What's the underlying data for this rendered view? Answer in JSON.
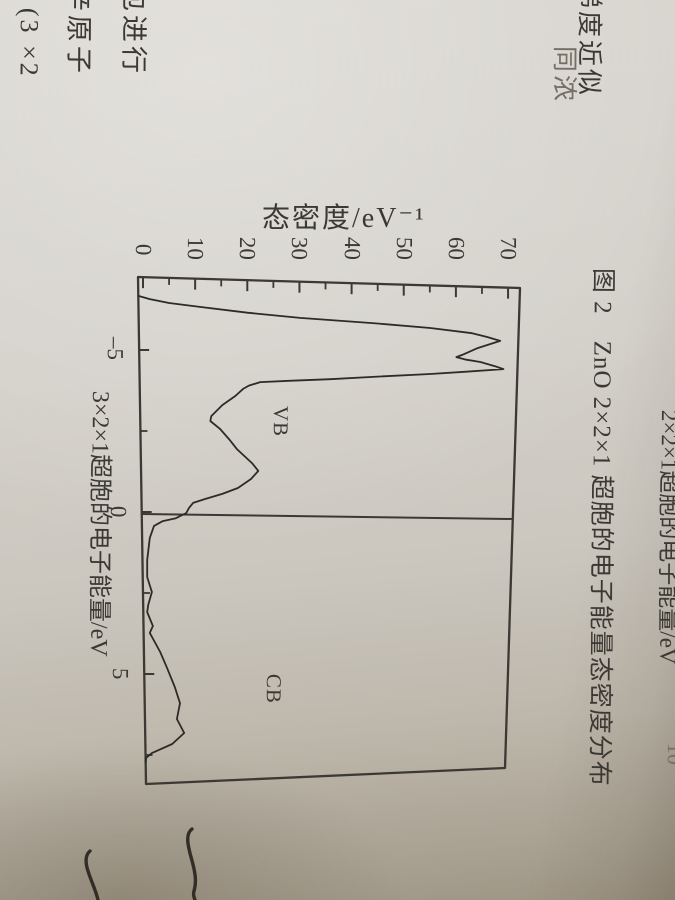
{
  "page": {
    "ylabel": "态密度/eV⁻¹",
    "vb_label": "VB",
    "cb_label": "CB",
    "fig3_xaxis_label": "3×2×1超胞的电子能量/eV",
    "fig2_xaxis_label": "2×2×1超胞的电子能量/eV",
    "fig2_caption": "图 2　ZnO 2×2×1 超胞的电子能量态密度分布",
    "page_number_fragment": "10",
    "body_text_fragments": {
      "line_end_1": "包进行",
      "line_end_2": "辛原子",
      "line_end_3": "(3 ×2",
      "line_end_4": "梯度近似",
      "line_end_5": "同浓"
    }
  },
  "chart_data": {
    "type": "line",
    "title": "ZnO supercell electronic density of states (figure printed sideways on page)",
    "xlabel": "3×2×1超胞的电子能量/eV",
    "ylabel": "态密度/eV⁻¹",
    "xlim": [
      -7.3,
      8.4
    ],
    "ylim": [
      0,
      70
    ],
    "x_ticks": [
      -5,
      0,
      5
    ],
    "x_ticks_minor": [
      -2.5,
      2.5,
      7.5
    ],
    "y_ticks": [
      0,
      10,
      20,
      30,
      40,
      50,
      60,
      70
    ],
    "y_ticks_minor": [
      5,
      15,
      25,
      35,
      45,
      55,
      65
    ],
    "fermi_line_x": 0,
    "annotations": [
      "VB",
      "CB"
    ],
    "legend": [],
    "grid": false,
    "series": [
      {
        "name": "total DOS",
        "energy": [
          -6.67,
          -6.57,
          -6.45,
          -6.33,
          -6.15,
          -5.99,
          -5.83,
          -5.68,
          -5.52,
          -5.4,
          -5.28,
          -5.05,
          -4.85,
          -4.78,
          -4.7,
          -4.63,
          -4.5,
          -4.41,
          -4.33,
          -4.26,
          -4.18,
          -4.1,
          -4.05,
          -4.01,
          -3.9,
          -3.8,
          -3.58,
          -3.3,
          -2.96,
          -2.81,
          -2.56,
          -2.25,
          -1.94,
          -1.51,
          -1.27,
          -1.02,
          -0.74,
          -0.56,
          -0.4,
          -0.28,
          -0.12,
          0.03,
          0.19,
          0.28,
          0.43,
          0.8,
          1.48,
          2.01,
          2.47,
          2.87,
          3.09,
          3.52,
          3.73,
          4.32,
          4.81,
          5.4,
          5.9,
          6.39,
          6.82,
          7.16,
          7.44,
          7.59,
          7.72
        ],
        "dos": [
          -0.9,
          1.3,
          5.0,
          10.9,
          20.0,
          30.1,
          44.0,
          55.1,
          63.1,
          66.0,
          68.5,
          64.0,
          61.2,
          60.1,
          62.0,
          64.7,
          67.5,
          69.1,
          62.0,
          55.1,
          45.0,
          35.9,
          28.0,
          22.5,
          20.3,
          19.2,
          17.7,
          15.2,
          13.1,
          12.9,
          14.8,
          16.5,
          18.0,
          20.9,
          22.1,
          20.7,
          18.2,
          15.2,
          11.9,
          9.6,
          8.8,
          8.3,
          6.3,
          3.8,
          2.1,
          1.3,
          0.8,
          0.8,
          1.7,
          1.0,
          0.8,
          1.9,
          1.3,
          3.3,
          4.6,
          6.1,
          7.1,
          6.5,
          7.9,
          5.6,
          1.7,
          0.6,
          0.5
        ]
      }
    ],
    "colors": {
      "ink": "#3c3833",
      "curve": "#2e2a26",
      "paper": "#d3d0c9"
    }
  }
}
